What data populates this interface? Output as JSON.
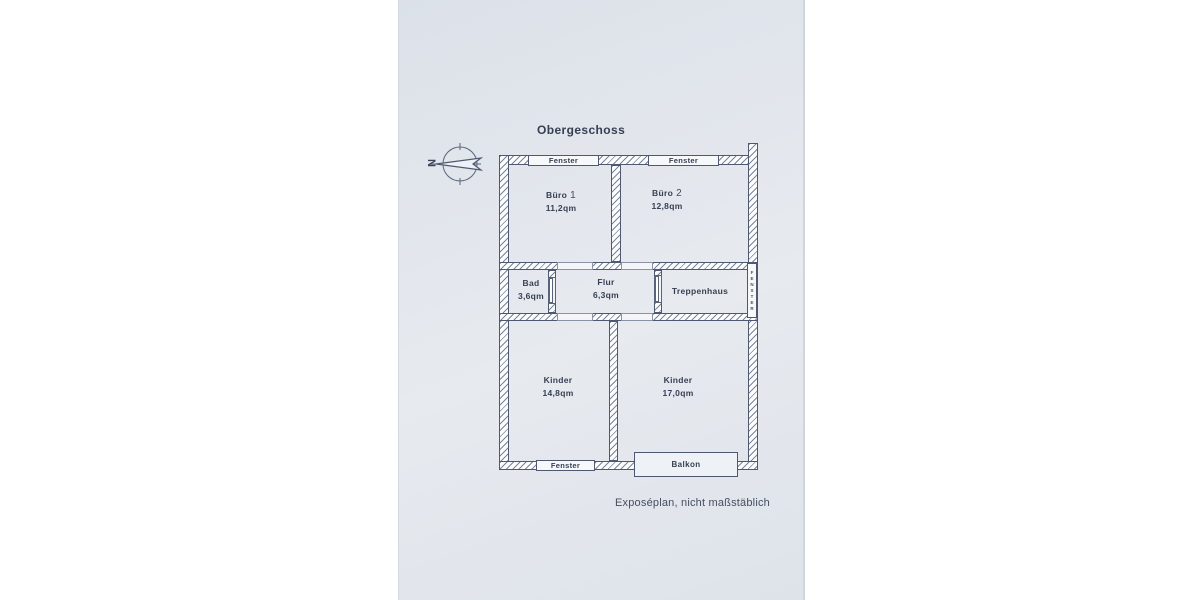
{
  "document": {
    "title": "Obergeschoss",
    "footer_note": "Exposéplan, nicht maßstäblich"
  },
  "compass": {
    "north_label": "N"
  },
  "floorplan": {
    "rooms": [
      {
        "id": "buero-1",
        "name": "Büro",
        "number": "1",
        "area": "11,2qm"
      },
      {
        "id": "buero-2",
        "name": "Büro",
        "number": "2",
        "area": "12,8qm"
      },
      {
        "id": "bad",
        "name": "Bad",
        "area": "3,6qm"
      },
      {
        "id": "flur",
        "name": "Flur",
        "area": "6,3qm"
      },
      {
        "id": "treppenhaus",
        "name": "Treppenhaus",
        "area": ""
      },
      {
        "id": "kinder-links",
        "name": "Kinder",
        "area": "14,8qm"
      },
      {
        "id": "kinder-rechts",
        "name": "Kinder",
        "area": "17,0qm"
      }
    ],
    "windows": {
      "top_left_label": "Fenster",
      "top_right_label": "Fenster",
      "bottom_label": "Fenster",
      "right_vertical_label": "FENSTER"
    },
    "balcony_label": "Balkon"
  },
  "colors": {
    "paper": "#e2e6ec",
    "wall_line": "#4e5870",
    "text": "#363f52"
  }
}
